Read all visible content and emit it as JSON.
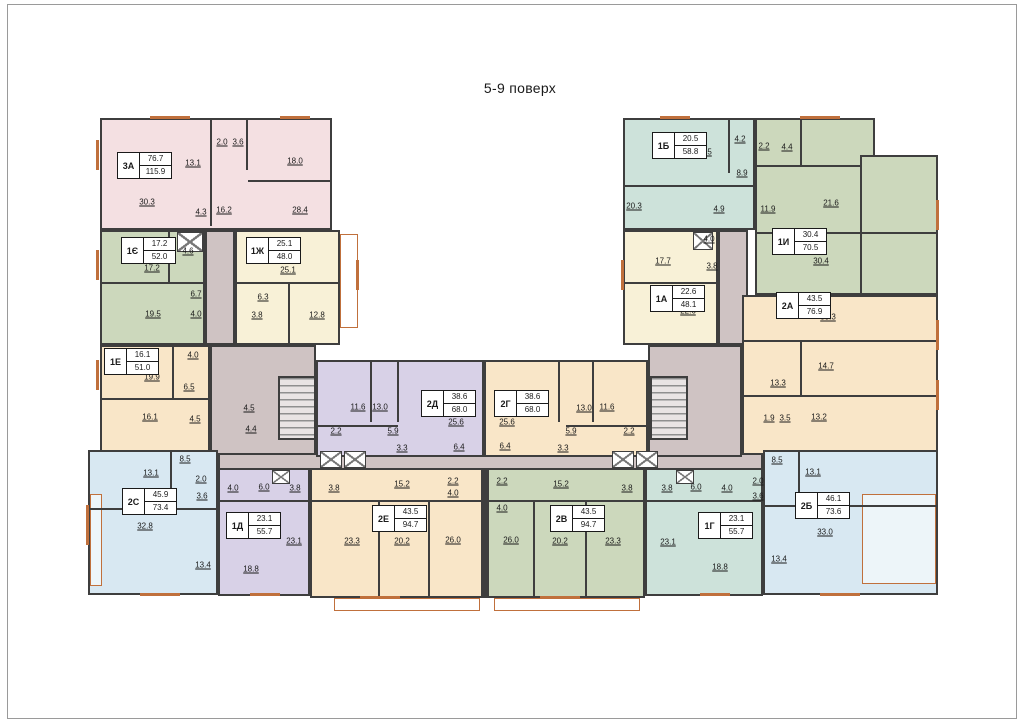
{
  "title": "5-9 поверх",
  "colors": {
    "pink": "#f4e0e2",
    "teal": "#cde2da",
    "green": "#ccd8bc",
    "cream": "#f8f1d7",
    "peach": "#f9e6c8",
    "lav": "#d8d1e7",
    "blue": "#d8e8f2",
    "mauve": "#cfc3c3",
    "wall": "#3e3e3e",
    "accent": "#c0703c"
  },
  "units": [
    {
      "code": "3А",
      "area_living": "76.7",
      "area_total": "115.9",
      "x": 117,
      "y": 152
    },
    {
      "code": "1Є",
      "area_living": "17.2",
      "area_total": "52.0",
      "x": 121,
      "y": 237
    },
    {
      "code": "1Ж",
      "area_living": "25.1",
      "area_total": "48.0",
      "x": 246,
      "y": 237
    },
    {
      "code": "1Е",
      "area_living": "16.1",
      "area_total": "51.0",
      "x": 104,
      "y": 348
    },
    {
      "code": "2С",
      "area_living": "45.9",
      "area_total": "73.4",
      "x": 122,
      "y": 488
    },
    {
      "code": "1Д",
      "area_living": "23.1",
      "area_total": "55.7",
      "x": 226,
      "y": 512
    },
    {
      "code": "2Е",
      "area_living": "43.5",
      "area_total": "94.7",
      "x": 372,
      "y": 505
    },
    {
      "code": "2Д",
      "area_living": "38.6",
      "area_total": "68.0",
      "x": 421,
      "y": 390
    },
    {
      "code": "2Г",
      "area_living": "38.6",
      "area_total": "68.0",
      "x": 494,
      "y": 390
    },
    {
      "code": "2В",
      "area_living": "43.5",
      "area_total": "94.7",
      "x": 550,
      "y": 505
    },
    {
      "code": "1Г",
      "area_living": "23.1",
      "area_total": "55.7",
      "x": 698,
      "y": 512
    },
    {
      "code": "2Б",
      "area_living": "46.1",
      "area_total": "73.6",
      "x": 795,
      "y": 492
    },
    {
      "code": "1А",
      "area_living": "22.6",
      "area_total": "48.1",
      "x": 650,
      "y": 285
    },
    {
      "code": "1Б",
      "area_living": "20.5",
      "area_total": "58.8",
      "x": 652,
      "y": 132
    },
    {
      "code": "1И",
      "area_living": "30.4",
      "area_total": "70.5",
      "x": 772,
      "y": 228
    },
    {
      "code": "2А",
      "area_living": "43.5",
      "area_total": "76.9",
      "x": 776,
      "y": 292
    }
  ],
  "room_labels": [
    {
      "t": "30.3",
      "x": 147,
      "y": 202
    },
    {
      "t": "13.1",
      "x": 193,
      "y": 163
    },
    {
      "t": "2.0",
      "x": 222,
      "y": 142
    },
    {
      "t": "3.6",
      "x": 238,
      "y": 142
    },
    {
      "t": "18.0",
      "x": 295,
      "y": 161
    },
    {
      "t": "4.3",
      "x": 201,
      "y": 212
    },
    {
      "t": "16.2",
      "x": 224,
      "y": 210
    },
    {
      "t": "28.4",
      "x": 300,
      "y": 210
    },
    {
      "t": "4.6",
      "x": 188,
      "y": 251
    },
    {
      "t": "17.2",
      "x": 152,
      "y": 268
    },
    {
      "t": "6.7",
      "x": 196,
      "y": 294
    },
    {
      "t": "19.5",
      "x": 153,
      "y": 314
    },
    {
      "t": "4.0",
      "x": 196,
      "y": 314
    },
    {
      "t": "25.1",
      "x": 288,
      "y": 270
    },
    {
      "t": "6.3",
      "x": 263,
      "y": 297
    },
    {
      "t": "3.8",
      "x": 257,
      "y": 315
    },
    {
      "t": "12.8",
      "x": 317,
      "y": 315
    },
    {
      "t": "4.0",
      "x": 193,
      "y": 355
    },
    {
      "t": "19.9",
      "x": 152,
      "y": 377
    },
    {
      "t": "6.5",
      "x": 189,
      "y": 387
    },
    {
      "t": "16.1",
      "x": 150,
      "y": 417
    },
    {
      "t": "4.5",
      "x": 195,
      "y": 419
    },
    {
      "t": "4.5",
      "x": 249,
      "y": 408
    },
    {
      "t": "4.4",
      "x": 251,
      "y": 429
    },
    {
      "t": "8.5",
      "x": 185,
      "y": 459
    },
    {
      "t": "13.1",
      "x": 151,
      "y": 473
    },
    {
      "t": "2.0",
      "x": 201,
      "y": 479
    },
    {
      "t": "3.6",
      "x": 202,
      "y": 496
    },
    {
      "t": "32.8",
      "x": 145,
      "y": 526
    },
    {
      "t": "13.4",
      "x": 203,
      "y": 565
    },
    {
      "t": "4.0",
      "x": 233,
      "y": 488
    },
    {
      "t": "6.0",
      "x": 264,
      "y": 487
    },
    {
      "t": "3.8",
      "x": 295,
      "y": 488
    },
    {
      "t": "23.1",
      "x": 294,
      "y": 541
    },
    {
      "t": "18.8",
      "x": 251,
      "y": 569
    },
    {
      "t": "3.8",
      "x": 334,
      "y": 488
    },
    {
      "t": "15.2",
      "x": 402,
      "y": 484
    },
    {
      "t": "2.2",
      "x": 453,
      "y": 481
    },
    {
      "t": "4.0",
      "x": 453,
      "y": 493
    },
    {
      "t": "23.3",
      "x": 352,
      "y": 541
    },
    {
      "t": "20.2",
      "x": 402,
      "y": 541
    },
    {
      "t": "26.0",
      "x": 453,
      "y": 540
    },
    {
      "t": "11.6",
      "x": 358,
      "y": 407
    },
    {
      "t": "13.0",
      "x": 380,
      "y": 407
    },
    {
      "t": "2.2",
      "x": 336,
      "y": 431
    },
    {
      "t": "5.9",
      "x": 393,
      "y": 431
    },
    {
      "t": "3.3",
      "x": 402,
      "y": 448
    },
    {
      "t": "25.6",
      "x": 456,
      "y": 422
    },
    {
      "t": "6.4",
      "x": 459,
      "y": 447
    },
    {
      "t": "25.6",
      "x": 507,
      "y": 422
    },
    {
      "t": "13.0",
      "x": 584,
      "y": 408
    },
    {
      "t": "11.6",
      "x": 607,
      "y": 407
    },
    {
      "t": "5.9",
      "x": 571,
      "y": 431
    },
    {
      "t": "2.2",
      "x": 629,
      "y": 431
    },
    {
      "t": "3.3",
      "x": 563,
      "y": 448
    },
    {
      "t": "6.4",
      "x": 505,
      "y": 446
    },
    {
      "t": "2.2",
      "x": 502,
      "y": 481
    },
    {
      "t": "15.2",
      "x": 561,
      "y": 484
    },
    {
      "t": "4.0",
      "x": 502,
      "y": 508
    },
    {
      "t": "26.0",
      "x": 511,
      "y": 540
    },
    {
      "t": "20.2",
      "x": 560,
      "y": 541
    },
    {
      "t": "23.3",
      "x": 613,
      "y": 541
    },
    {
      "t": "3.8",
      "x": 627,
      "y": 488
    },
    {
      "t": "3.8",
      "x": 667,
      "y": 488
    },
    {
      "t": "6.0",
      "x": 696,
      "y": 487
    },
    {
      "t": "4.0",
      "x": 727,
      "y": 488
    },
    {
      "t": "23.1",
      "x": 668,
      "y": 542
    },
    {
      "t": "18.8",
      "x": 720,
      "y": 567
    },
    {
      "t": "2.0",
      "x": 758,
      "y": 481
    },
    {
      "t": "3.6",
      "x": 758,
      "y": 496
    },
    {
      "t": "8.5",
      "x": 777,
      "y": 460
    },
    {
      "t": "13.1",
      "x": 813,
      "y": 472
    },
    {
      "t": "33.0",
      "x": 825,
      "y": 532
    },
    {
      "t": "13.4",
      "x": 779,
      "y": 559
    },
    {
      "t": "20.5",
      "x": 704,
      "y": 152
    },
    {
      "t": "4.2",
      "x": 740,
      "y": 139
    },
    {
      "t": "8.9",
      "x": 742,
      "y": 173
    },
    {
      "t": "20.3",
      "x": 634,
      "y": 206
    },
    {
      "t": "4.9",
      "x": 719,
      "y": 209
    },
    {
      "t": "2.2",
      "x": 764,
      "y": 146
    },
    {
      "t": "4.4",
      "x": 787,
      "y": 147
    },
    {
      "t": "11.9",
      "x": 768,
      "y": 209
    },
    {
      "t": "21.6",
      "x": 831,
      "y": 203
    },
    {
      "t": "30.4",
      "x": 821,
      "y": 261
    },
    {
      "t": "17.7",
      "x": 663,
      "y": 261
    },
    {
      "t": "4.0",
      "x": 709,
      "y": 239
    },
    {
      "t": "3.8",
      "x": 712,
      "y": 266
    },
    {
      "t": "22.6",
      "x": 688,
      "y": 311
    },
    {
      "t": "30.3",
      "x": 828,
      "y": 317
    },
    {
      "t": "14.7",
      "x": 826,
      "y": 366
    },
    {
      "t": "13.3",
      "x": 778,
      "y": 383
    },
    {
      "t": "1.9",
      "x": 769,
      "y": 418
    },
    {
      "t": "3.5",
      "x": 785,
      "y": 418
    },
    {
      "t": "13.2",
      "x": 819,
      "y": 417
    }
  ],
  "blocks": [
    {
      "n": "corridor-top-left",
      "x": 205,
      "y": 230,
      "w": 30,
      "h": 115,
      "f": "mauve"
    },
    {
      "n": "corridor-left",
      "x": 210,
      "y": 345,
      "w": 106,
      "h": 112,
      "f": "mauve"
    },
    {
      "n": "corridor-spine",
      "x": 218,
      "y": 453,
      "w": 545,
      "h": 17,
      "f": "mauve"
    },
    {
      "n": "corridor-top-right",
      "x": 718,
      "y": 230,
      "w": 30,
      "h": 115,
      "f": "mauve"
    },
    {
      "n": "corridor-right",
      "x": 648,
      "y": 345,
      "w": 94,
      "h": 112,
      "f": "mauve"
    },
    {
      "n": "apartment-3a",
      "x": 100,
      "y": 118,
      "w": 232,
      "h": 112,
      "f": "pink"
    },
    {
      "n": "apartment-1ye",
      "x": 100,
      "y": 230,
      "w": 105,
      "h": 115,
      "f": "green"
    },
    {
      "n": "apartment-1zh",
      "x": 235,
      "y": 230,
      "w": 105,
      "h": 115,
      "f": "cream"
    },
    {
      "n": "apartment-1e",
      "x": 100,
      "y": 345,
      "w": 110,
      "h": 112,
      "f": "peach"
    },
    {
      "n": "apartment-2d",
      "x": 316,
      "y": 360,
      "w": 168,
      "h": 97,
      "f": "lav"
    },
    {
      "n": "apartment-2g",
      "x": 484,
      "y": 360,
      "w": 164,
      "h": 97,
      "f": "peach"
    },
    {
      "n": "apartment-1b",
      "x": 623,
      "y": 118,
      "w": 132,
      "h": 112,
      "f": "teal"
    },
    {
      "n": "apartment-1i-main",
      "x": 755,
      "y": 118,
      "w": 120,
      "h": 177,
      "f": "green"
    },
    {
      "n": "apartment-1i-east",
      "x": 860,
      "y": 155,
      "w": 78,
      "h": 140,
      "f": "green"
    },
    {
      "n": "apartment-1a",
      "x": 623,
      "y": 230,
      "w": 95,
      "h": 115,
      "f": "cream"
    },
    {
      "n": "apartment-2a",
      "x": 742,
      "y": 295,
      "w": 196,
      "h": 160,
      "f": "peach"
    },
    {
      "n": "apartment-2s",
      "x": 88,
      "y": 450,
      "w": 130,
      "h": 145,
      "f": "blue"
    },
    {
      "n": "apartment-1d",
      "x": 218,
      "y": 468,
      "w": 92,
      "h": 128,
      "f": "lav"
    },
    {
      "n": "apartment-2ye",
      "x": 310,
      "y": 468,
      "w": 175,
      "h": 130,
      "f": "peach"
    },
    {
      "n": "apartment-2v",
      "x": 485,
      "y": 468,
      "w": 160,
      "h": 130,
      "f": "green"
    },
    {
      "n": "apartment-1g",
      "x": 645,
      "y": 468,
      "w": 118,
      "h": 128,
      "f": "teal"
    },
    {
      "n": "apartment-2b",
      "x": 763,
      "y": 450,
      "w": 175,
      "h": 145,
      "f": "blue"
    }
  ],
  "partitions": [
    [
      210,
      120,
      2,
      106
    ],
    [
      246,
      120,
      2,
      50
    ],
    [
      248,
      180,
      84,
      2
    ],
    [
      100,
      282,
      105,
      2
    ],
    [
      168,
      230,
      2,
      52
    ],
    [
      235,
      282,
      105,
      2
    ],
    [
      288,
      282,
      2,
      63
    ],
    [
      100,
      398,
      110,
      2
    ],
    [
      172,
      345,
      2,
      53
    ],
    [
      370,
      360,
      2,
      62
    ],
    [
      397,
      360,
      2,
      62
    ],
    [
      316,
      425,
      82,
      2
    ],
    [
      558,
      360,
      2,
      62
    ],
    [
      592,
      360,
      2,
      62
    ],
    [
      566,
      425,
      82,
      2
    ],
    [
      88,
      508,
      130,
      2
    ],
    [
      170,
      450,
      2,
      56
    ],
    [
      763,
      505,
      175,
      2
    ],
    [
      798,
      450,
      2,
      53
    ],
    [
      218,
      500,
      92,
      2
    ],
    [
      645,
      500,
      118,
      2
    ],
    [
      310,
      500,
      175,
      2
    ],
    [
      378,
      500,
      2,
      96
    ],
    [
      428,
      500,
      2,
      96
    ],
    [
      485,
      500,
      160,
      2
    ],
    [
      533,
      500,
      2,
      96
    ],
    [
      585,
      500,
      2,
      96
    ],
    [
      742,
      340,
      196,
      2
    ],
    [
      742,
      395,
      196,
      2
    ],
    [
      800,
      340,
      2,
      57
    ],
    [
      623,
      282,
      95,
      2
    ],
    [
      728,
      118,
      2,
      55
    ],
    [
      623,
      185,
      132,
      2
    ],
    [
      800,
      118,
      2,
      49
    ],
    [
      755,
      165,
      107,
      2
    ],
    [
      755,
      232,
      183,
      2
    ],
    [
      481,
      468,
      8,
      130
    ]
  ],
  "windows": [
    [
      96,
      140,
      3,
      30
    ],
    [
      96,
      250,
      3,
      30
    ],
    [
      96,
      360,
      3,
      30
    ],
    [
      86,
      505,
      3,
      40
    ],
    [
      150,
      116,
      40,
      3
    ],
    [
      280,
      116,
      30,
      3
    ],
    [
      660,
      116,
      30,
      3
    ],
    [
      800,
      116,
      40,
      3
    ],
    [
      140,
      593,
      40,
      3
    ],
    [
      250,
      593,
      30,
      3
    ],
    [
      360,
      596,
      40,
      3
    ],
    [
      540,
      596,
      40,
      3
    ],
    [
      700,
      593,
      30,
      3
    ],
    [
      820,
      593,
      40,
      3
    ],
    [
      936,
      200,
      3,
      30
    ],
    [
      936,
      320,
      3,
      30
    ],
    [
      936,
      380,
      3,
      30
    ],
    [
      356,
      260,
      3,
      30
    ],
    [
      621,
      260,
      3,
      30
    ]
  ],
  "features": {
    "stairs": [
      [
        278,
        376,
        38,
        64
      ],
      [
        650,
        376,
        38,
        64
      ]
    ],
    "lifts": [
      [
        320,
        451,
        22,
        17
      ],
      [
        344,
        451,
        22,
        17
      ],
      [
        612,
        451,
        22,
        17
      ],
      [
        636,
        451,
        22,
        17
      ]
    ],
    "vents": [
      [
        177,
        232,
        26,
        20
      ],
      [
        693,
        232,
        20,
        18
      ],
      [
        272,
        470,
        18,
        14
      ],
      [
        676,
        470,
        18,
        14
      ]
    ],
    "balconies": [
      [
        340,
        234,
        18,
        94
      ],
      [
        90,
        494,
        12,
        92
      ],
      [
        862,
        494,
        74,
        90
      ],
      [
        334,
        598,
        146,
        13
      ],
      [
        494,
        598,
        146,
        13
      ]
    ]
  }
}
